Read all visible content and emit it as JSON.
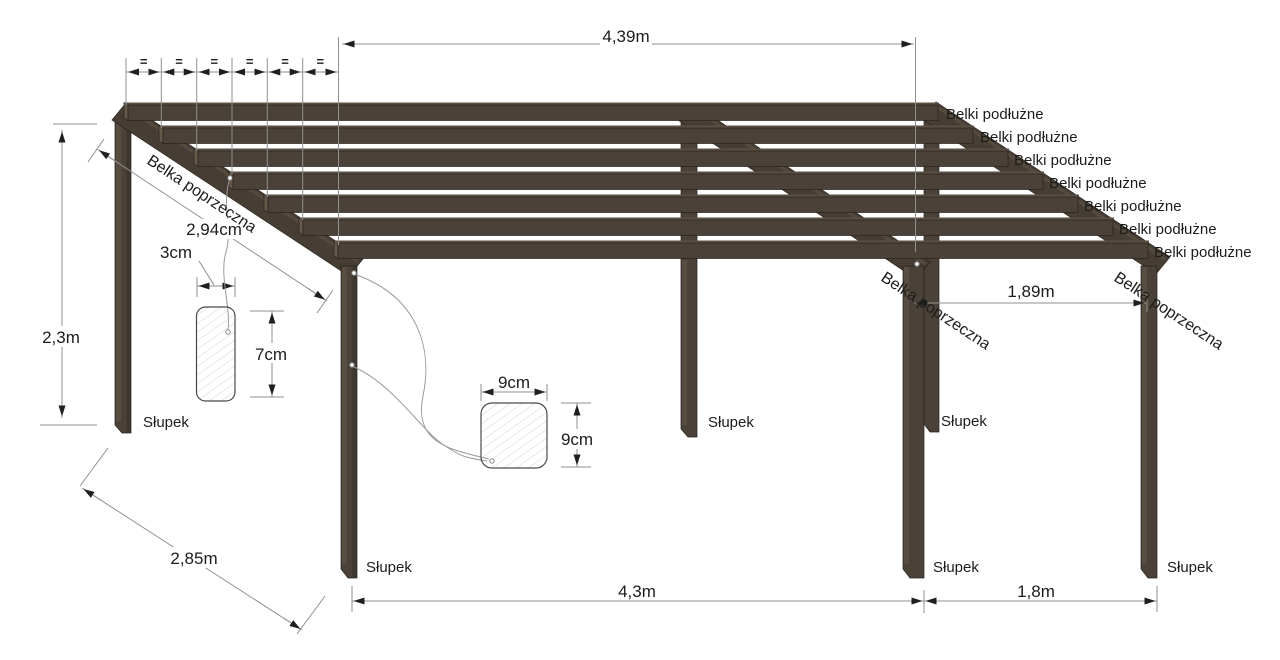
{
  "diagram": {
    "title": "pergola-construction-drawing",
    "labels": {
      "longitudinal_beam": "Belki podłużne",
      "transverse_beam": "Belka poprzeczna",
      "post": "Słupek",
      "equal_spacing_mark": "="
    },
    "counts": {
      "longitudinal_beams": 7,
      "transverse_beams": 3,
      "posts": 6,
      "equal_spacing_segments": 6
    },
    "dimensions": {
      "roof_span_top": "4,39m",
      "post_height": "2,3m",
      "transverse_beam_length": "2,94cm",
      "beam_section_width": "3cm",
      "beam_section_height": "7cm",
      "post_section_width": "9cm",
      "post_section_height": "9cm",
      "right_bay_roof_span": "1,89m",
      "depth_span": "2,85m",
      "bottom_main_span": "4,3m",
      "bottom_side_span": "1,8m"
    },
    "colors": {
      "wood_face": "#4a4138",
      "wood_top": "#5a4f43",
      "wood_end": "#655849",
      "wood_transverse": "#463d34",
      "outline": "#29231e",
      "dimension_line": "#8f8f8f",
      "arrow": "#1f1f1f",
      "text": "#1d1c1a",
      "hatch": "#d5d5d5",
      "background": "#ffffff"
    }
  }
}
